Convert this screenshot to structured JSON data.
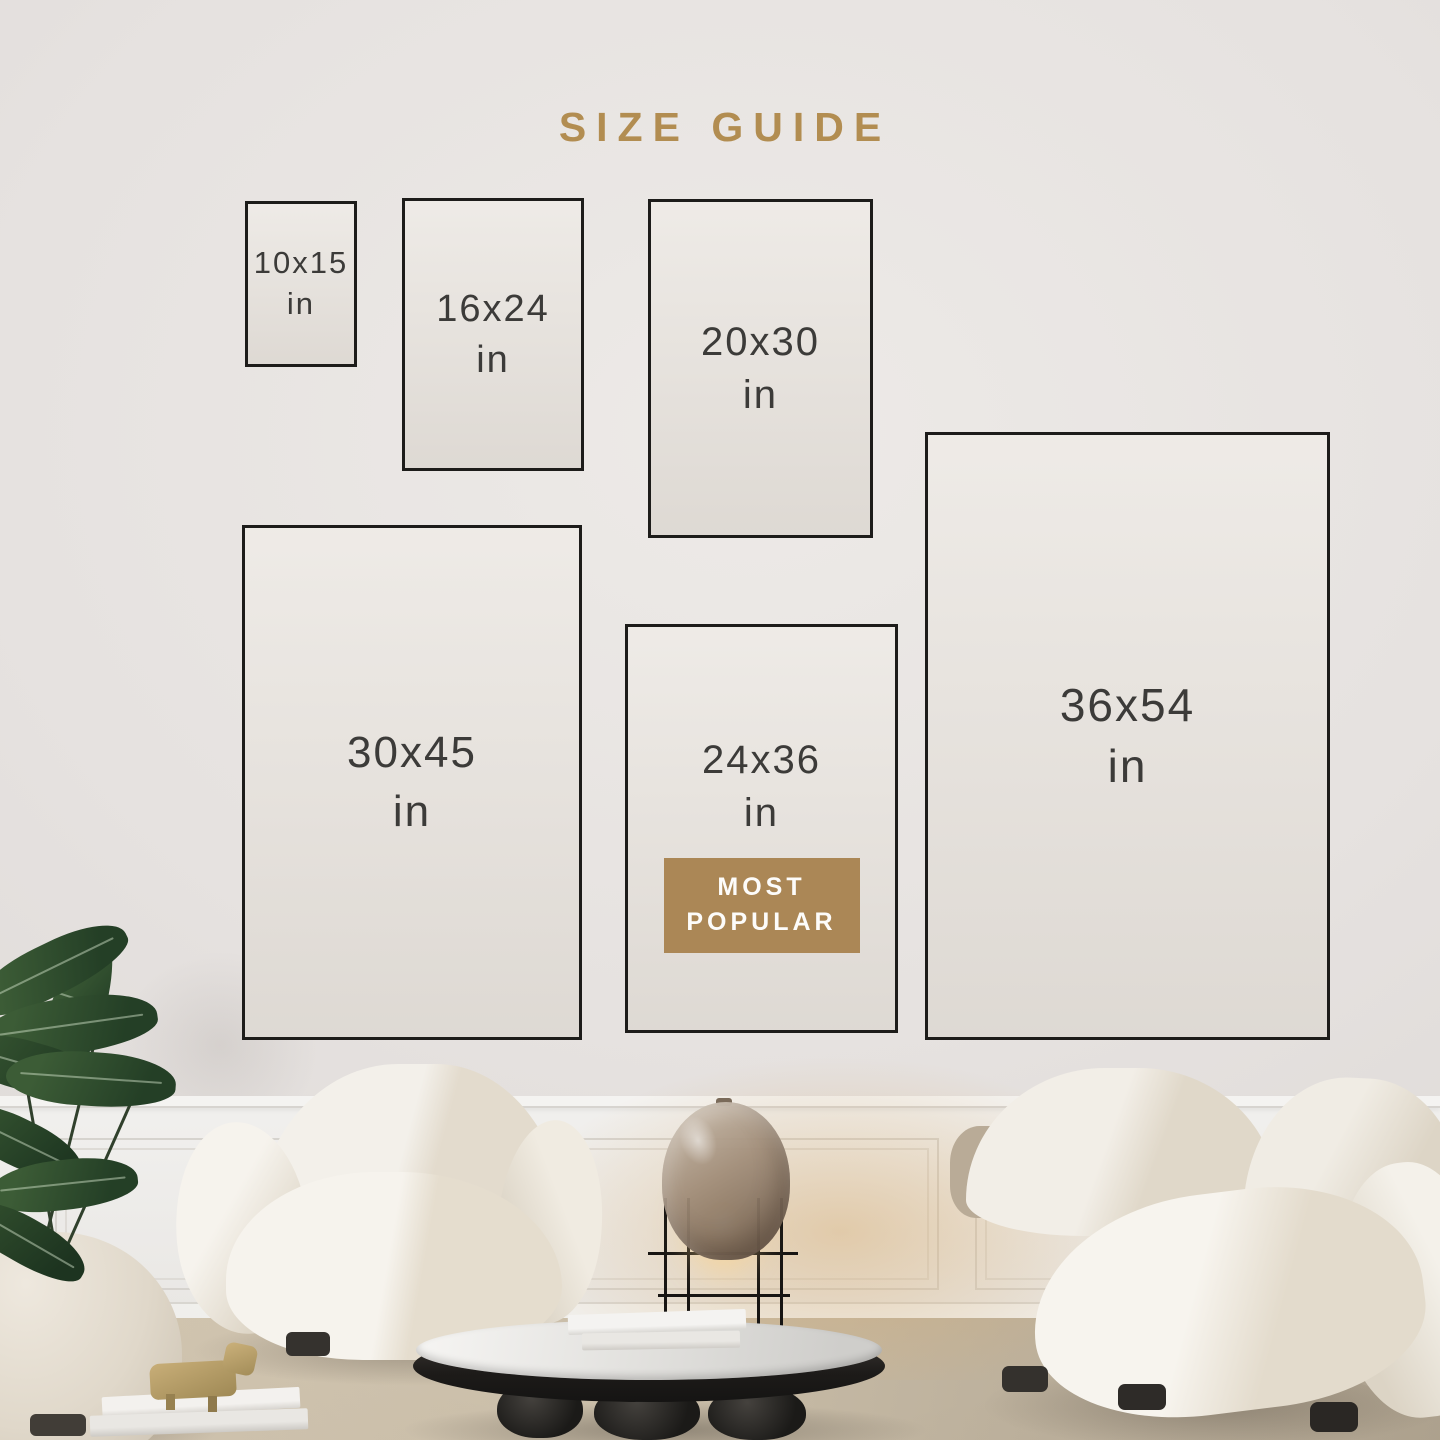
{
  "title": "SIZE GUIDE",
  "sizes": [
    {
      "label": "10x15",
      "unit": "in"
    },
    {
      "label": "16x24",
      "unit": "in"
    },
    {
      "label": "20x30",
      "unit": "in"
    },
    {
      "label": "30x45",
      "unit": "in"
    },
    {
      "label": "24x36",
      "unit": "in",
      "badge": "MOST POPULAR"
    },
    {
      "label": "36x54",
      "unit": "in"
    }
  ],
  "theme": {
    "title_color": "#b28d51",
    "badge_background": "#ab8756",
    "badge_text_color": "#fdfcfa",
    "size_text_color": "#3c3b39",
    "box_border_color": "#1d1c1a",
    "box_fill_color": "#e7e2dc"
  }
}
